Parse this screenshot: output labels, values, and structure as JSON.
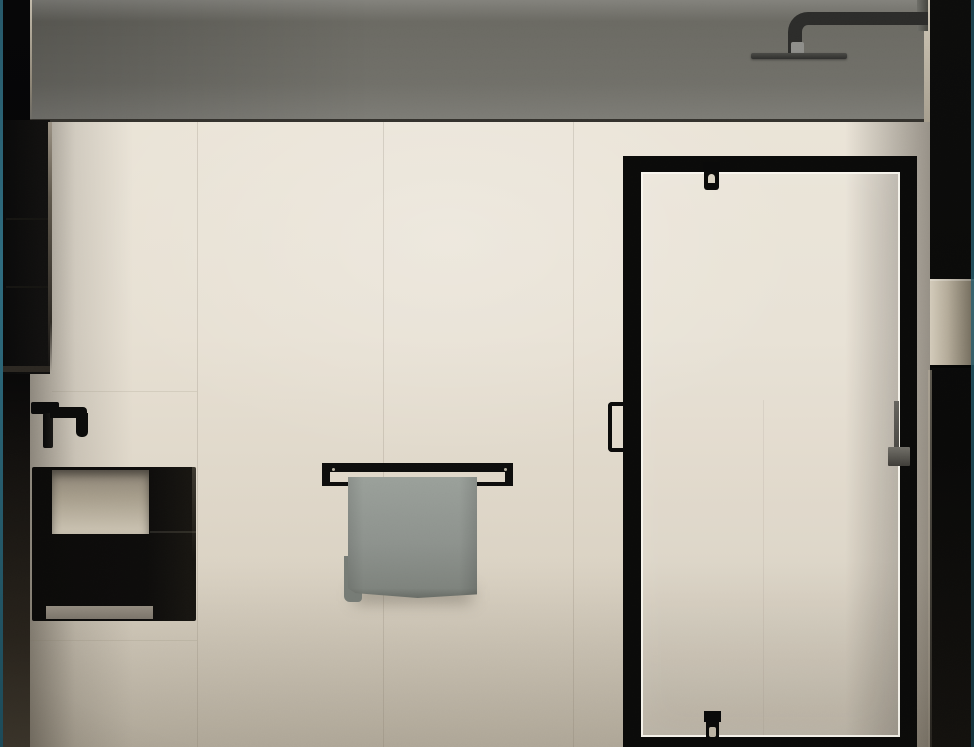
{
  "scene": {
    "type": "3d-interior-render",
    "setting": "minimalist beige-tiled bathroom wall elevation",
    "objects": [
      {
        "name": "upper-wall-band",
        "label": "dark gray upper wall / bulkhead",
        "color": "#6b6a63"
      },
      {
        "name": "rain-shower-head",
        "label": "charcoal wall-arm rain shower head",
        "color": "#2c2c2a"
      },
      {
        "name": "shower-enclosure",
        "label": "black framed glass walk-in shower",
        "frame_color": "#0b0b0a",
        "glass_edge_color": "#f9f6ef"
      },
      {
        "name": "shower-door-handle",
        "label": "black vertical D-handle on glass door",
        "color": "#0c0c0b"
      },
      {
        "name": "glass-clamp-top",
        "label": "black glass clamp at top rail",
        "color": "#0a0a0a"
      },
      {
        "name": "glass-clamp-bottom",
        "label": "black glass clamp at bottom rail",
        "color": "#0a0a0a"
      },
      {
        "name": "hand-shower-rail",
        "label": "gray slide rail inside shower",
        "color": "#5d5b55"
      },
      {
        "name": "towel-rail",
        "label": "black wall-mounted towel rail",
        "color": "#0e0e0d"
      },
      {
        "name": "towel",
        "label": "gray folded towel hanging on rail",
        "color": "#8f948f"
      },
      {
        "name": "wall-faucet",
        "label": "matte black wall-mounted basin mixer",
        "color": "#0b0b0b"
      },
      {
        "name": "vanity-basin",
        "label": "black wall-hung basin unit with open niche",
        "color": "#0d0c0b",
        "niche_color": "#b0a795"
      },
      {
        "name": "left-cabinet",
        "label": "tall dark cabinet panel on left wall",
        "color": "#0f0e0d"
      },
      {
        "name": "left-wall-column",
        "label": "dark wall return at left edge",
        "color": "#070708"
      },
      {
        "name": "right-wall-column",
        "label": "dark wall column with beige niche at right edge",
        "color": "#0d0d0c"
      },
      {
        "name": "wall-tiles",
        "label": "large-format beige stone tiles",
        "color": "#e7e0d3"
      }
    ],
    "palette": {
      "wall_light": "#ece6da",
      "wall_dark": "#c8c0b0",
      "band_gray": "#6b6a63",
      "fixture_black": "#0b0b0a",
      "towel_gray": "#8f948f",
      "niche_tan": "#b4ab99",
      "edge_teal": "#2f6c7f"
    }
  }
}
